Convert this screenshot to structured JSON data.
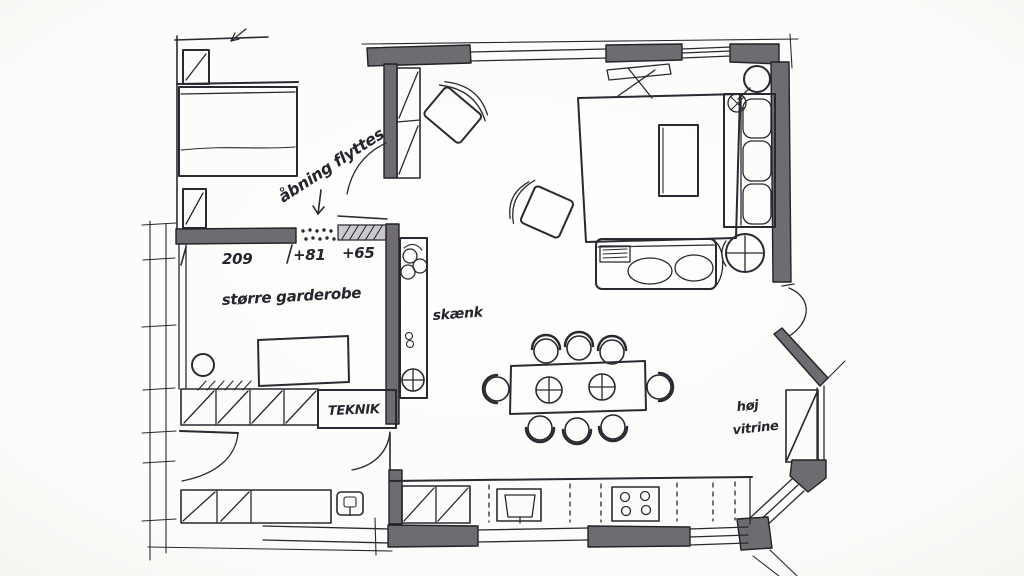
{
  "canvas": {
    "width": 1024,
    "height": 576
  },
  "style": {
    "paper_color": "#fdfdfc",
    "ink_color": "#2a2830",
    "wall_color": "#6e6b71",
    "hatch_wall_color": "#cbc9cd"
  },
  "labels": {
    "opening_note": "åbning flyttes",
    "dim_wardrobe_width": "209",
    "dim_opening_81": "+81",
    "dim_opening_65": "+65",
    "room_wardrobe": "større garderobe",
    "furniture_sideboard": "skænk",
    "room_utility": "TEKNIK",
    "tall_cabinet_line1": "høj",
    "tall_cabinet_line2": "vitrine"
  },
  "features": [
    "bed",
    "nightstands",
    "entry-wardrobe",
    "walk-in-wardrobe",
    "utility-closet",
    "sideboard-with-plant",
    "dining-table-with-8-chairs",
    "rug",
    "coffee-table",
    "sofa-right",
    "sofa-bottom",
    "two-armchairs",
    "round-side-table",
    "floor-lamp",
    "kitchen-counter",
    "stove",
    "sink",
    "tall-display-cabinet",
    "bay-windows",
    "door-swings",
    "moved-opening-dotted"
  ]
}
